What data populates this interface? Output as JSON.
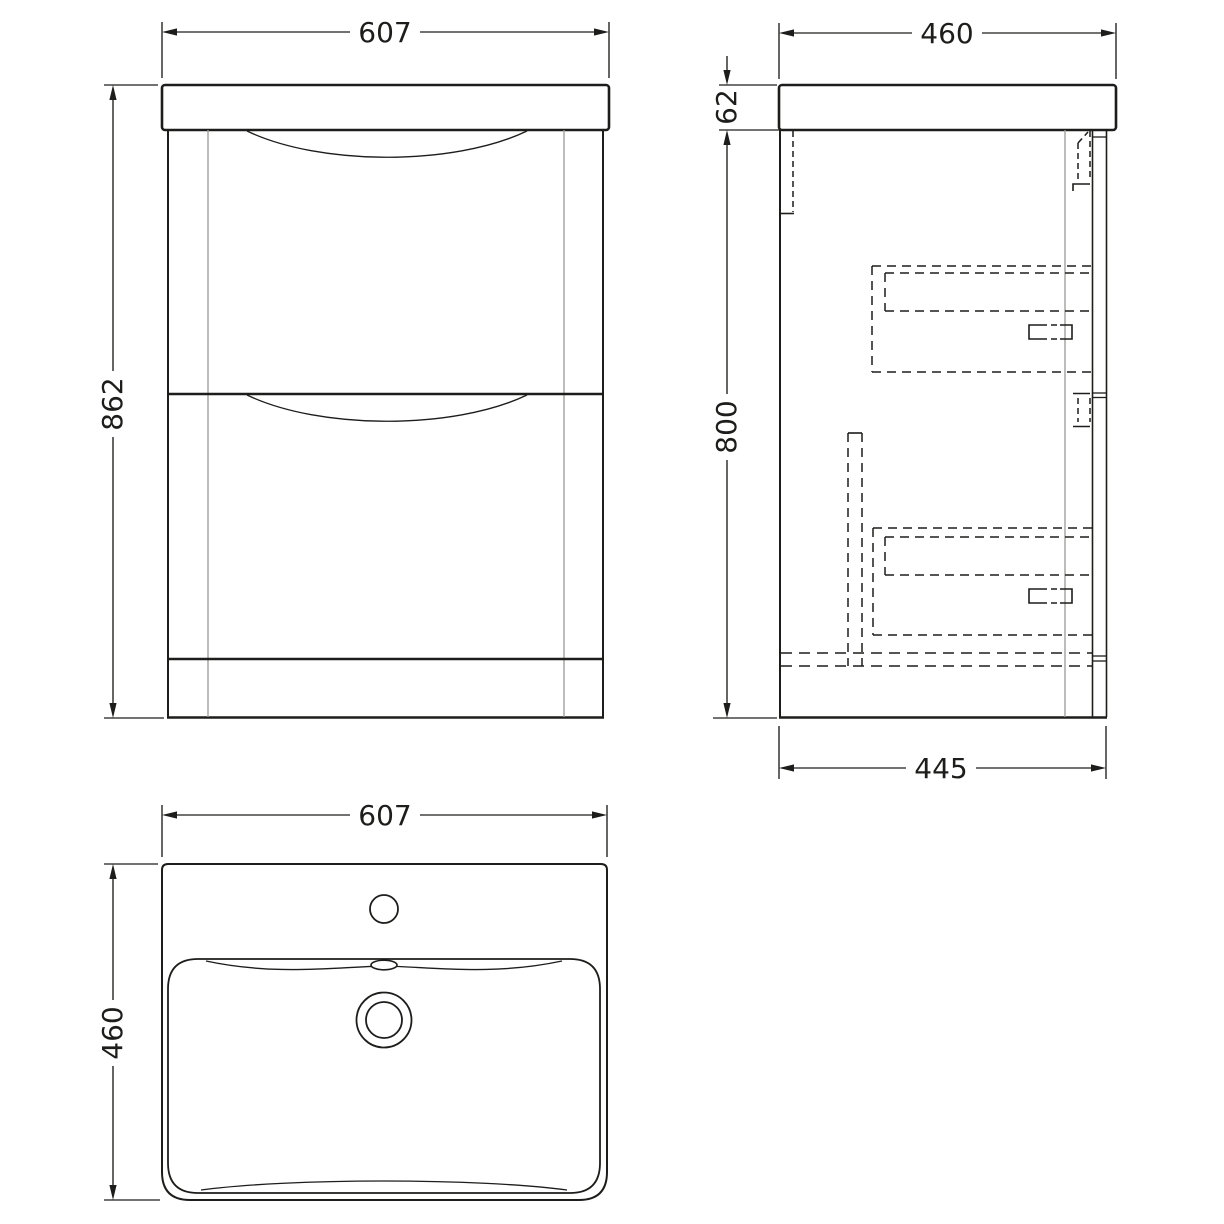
{
  "drawing": {
    "colors": {
      "line": "#1d1d1b",
      "secondary_line": "#9d9d9c",
      "background": "#ffffff"
    },
    "views": {
      "front": {
        "dimensions": {
          "width": "607",
          "height": "862"
        }
      },
      "side": {
        "dimensions": {
          "depth": "460",
          "basin_height": "62",
          "cabinet_height": "800",
          "base_depth": "445"
        }
      },
      "plan": {
        "dimensions": {
          "width": "607",
          "depth": "460"
        }
      }
    }
  }
}
